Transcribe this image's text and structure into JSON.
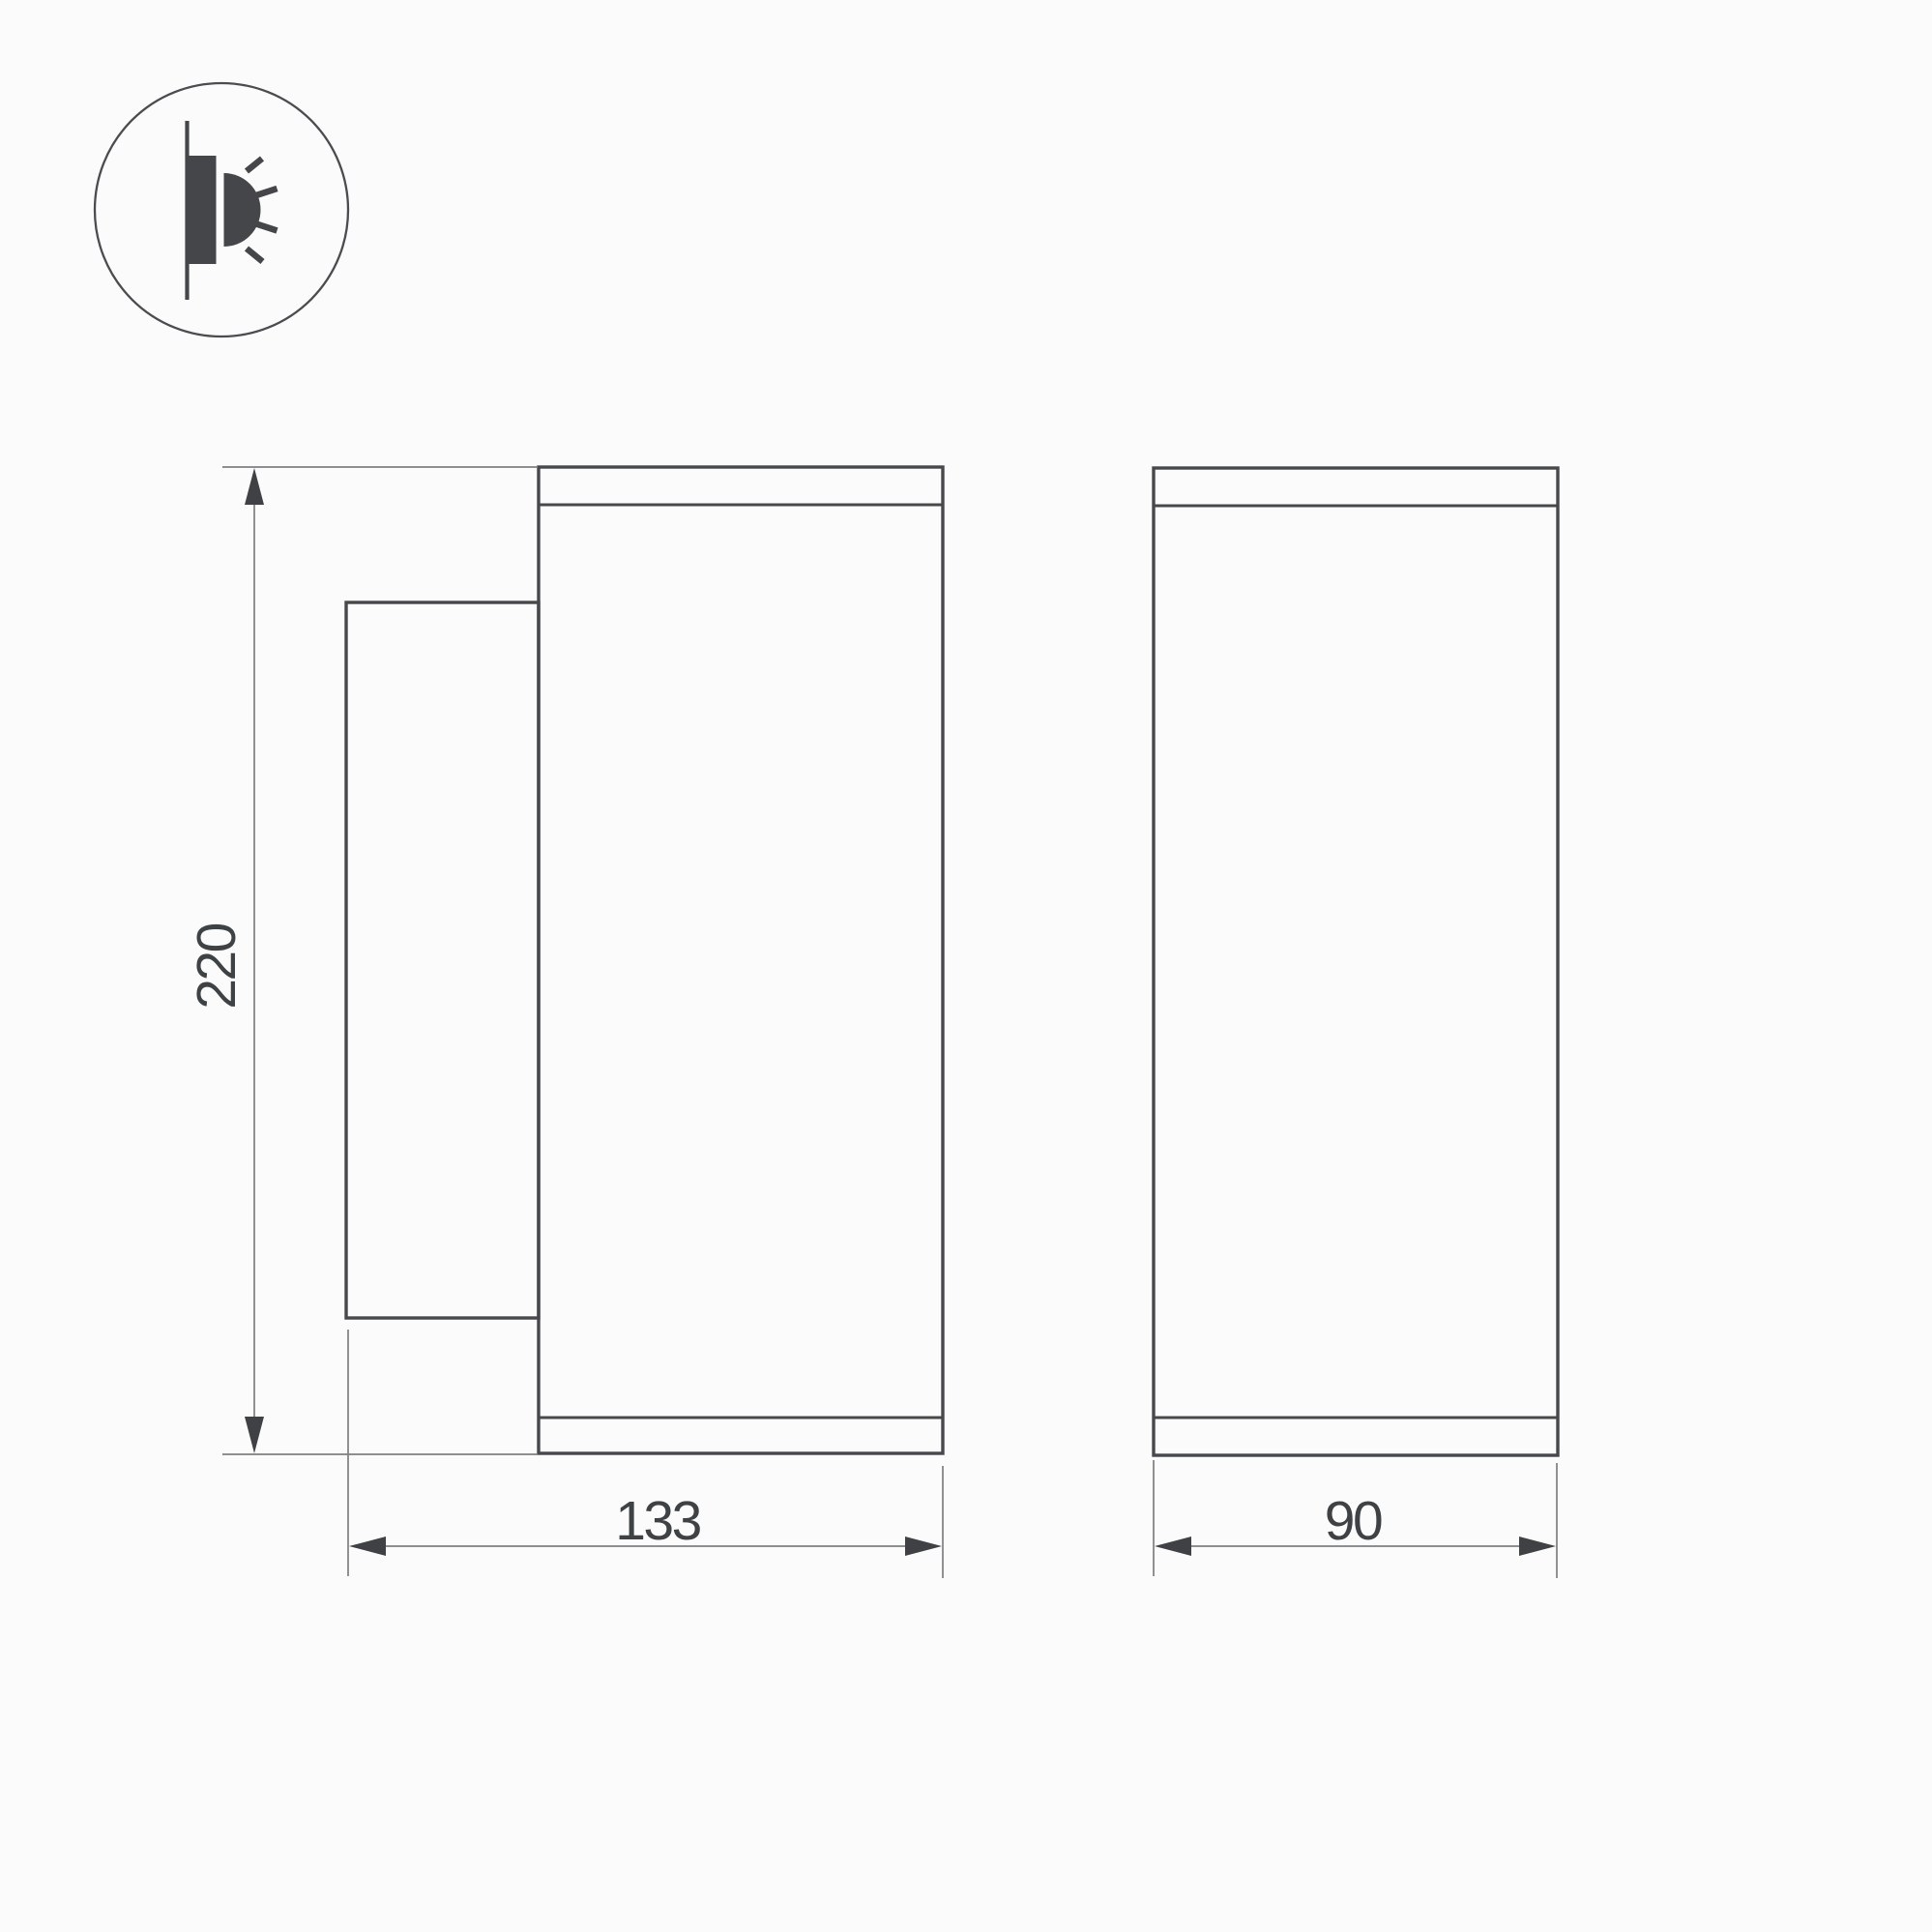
{
  "drawing": {
    "icon": {
      "name": "wall-mounted-light-icon",
      "description": "surface wall mount fixture emitting light sideways"
    },
    "dimensions": {
      "height": "220",
      "depth": "133",
      "width": "90"
    },
    "colors": {
      "background": "#fbfbfb",
      "outline": "#47484b",
      "dimension_line": "#7c7e80",
      "arrow": "#404144",
      "text": "#3f4245"
    }
  }
}
